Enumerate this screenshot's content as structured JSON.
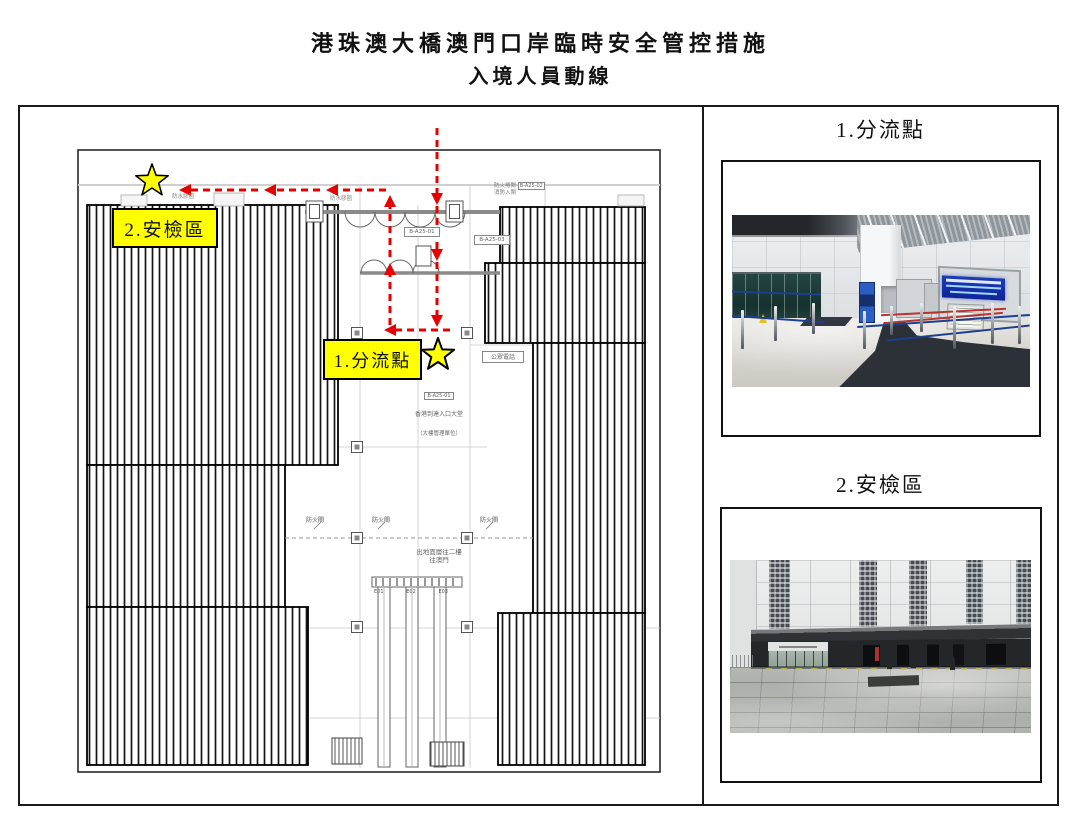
{
  "page": {
    "title": {
      "line1": "港珠澳大橋澳門口岸臨時安全管控措施",
      "line2": "入境人員動線"
    }
  },
  "plan": {
    "marker1": "1.分流點",
    "marker2": "2.安檢區",
    "notes": {
      "top_shutter": "防火捲閘",
      "top_shutter_code": "B-A25-02",
      "top_entry": "消防入閘",
      "seal1": "防水膠圈",
      "seal2": "防水膠圈",
      "code_a": "B-A25-01",
      "code_b": "B-A25-03",
      "public_phone": "公眾電話",
      "fire_shutter": "防火閘",
      "hall_code": "B-A25-01",
      "hall_name": "香港到達入口大堂",
      "hall_sub": "（大樓管理單位）",
      "exit_line1": "出地面層往二樓",
      "exit_line2": "往澳門",
      "escalators": [
        "E01",
        "E02",
        "E03"
      ]
    }
  },
  "right_panel": {
    "section1": {
      "heading": "1.分流點"
    },
    "section2": {
      "heading": "2.安檢區"
    }
  },
  "colors": {
    "flow_red": "#e60000",
    "marker_yellow": "#ffff00",
    "led_sign_blue": "#16309b"
  }
}
